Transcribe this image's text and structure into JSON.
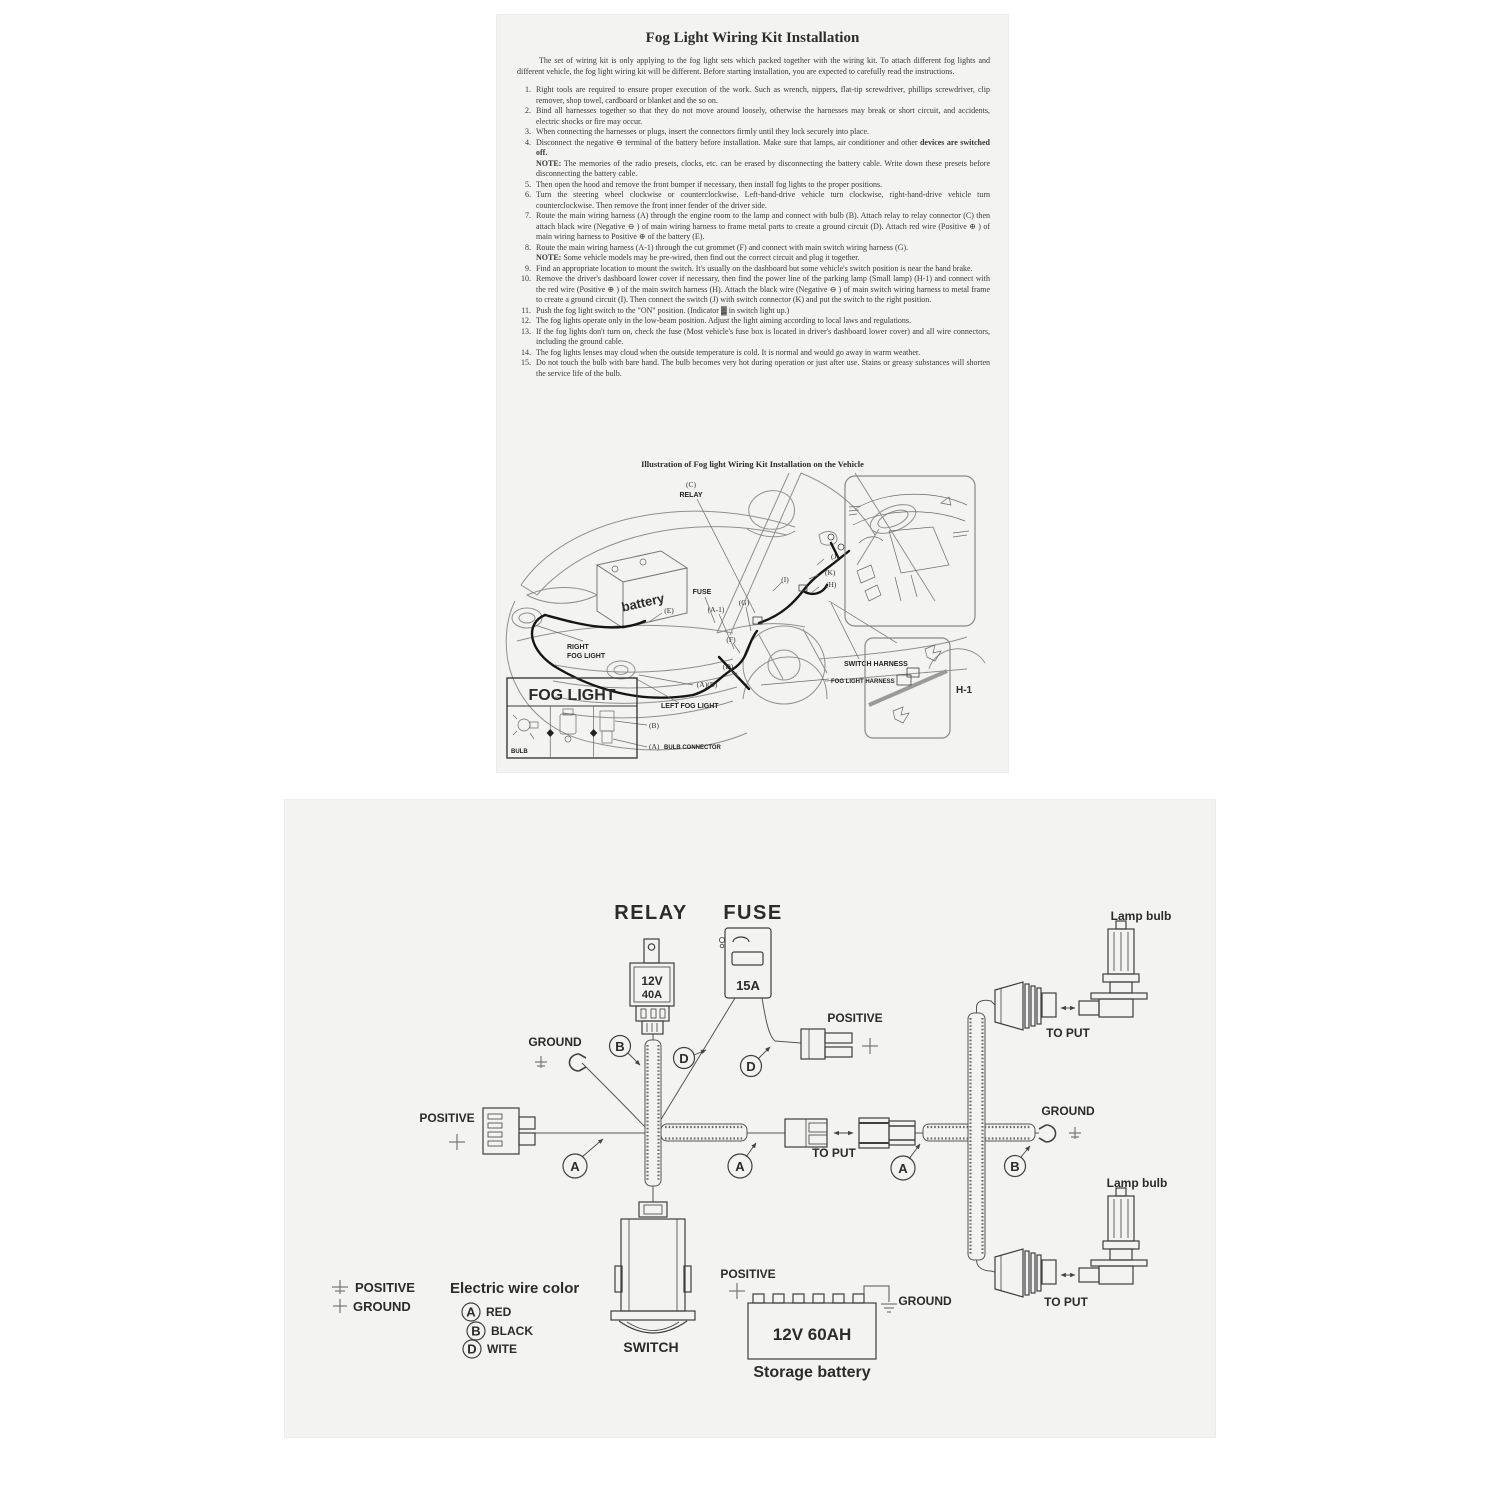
{
  "doc1": {
    "title": "Fog Light Wiring Kit Installation",
    "intro": "The set of wiring kit is only applying to the fog light sets which packed together with the wiring kit. To attach different fog lights and different vehicle, the fog light wiring kit will be different. Before starting installation, you are expected to carefully read the instructions.",
    "note_label": "NOTE:",
    "items": [
      {
        "num": "1.",
        "text": "Right tools are required to ensure proper execution of the work. Such as wrench, nippers, flat-tip screwdriver, phillips screwdriver, clip remover, shop towel, cardboard or blanket and the so on."
      },
      {
        "num": "2.",
        "text": "Bind all harnesses together so that they do not move around loosely, otherwise the harnesses may break or short circuit, and accidents, electric shocks or fire may occur."
      },
      {
        "num": "3.",
        "text": "When connecting the harnesses or plugs, insert the connectors firmly until they lock securely into place."
      },
      {
        "num": "4.",
        "text": "Disconnect the negative ⊖ terminal of the battery before installation. Make sure that lamps, air conditioner and other ",
        "bold": "devices are switched off.",
        "note": "The memories of the radio presets, clocks, etc. can be erased by disconnecting the battery cable. Write down these presets before disconnecting the battery cable."
      },
      {
        "num": "5.",
        "text": "Then open the hood and remove the front bumper if necessary, then install fog lights to the proper positions."
      },
      {
        "num": "6.",
        "text": "Turn the steering wheel clockwise or counterclockwise. Left-hand-drive vehicle turn clockwise, right-hand-drive vehicle turn counterclockwise. Then remove the front inner fender of the driver side."
      },
      {
        "num": "7.",
        "text": "Route the main wiring harness (A) through the engine room to the lamp and connect with bulb (B). Attach relay to relay connector (C) then attach black wire (Negative ⊖ ) of main wiring harness to frame metal parts to create a ground circuit (D). Attach red wire (Positive ⊕ ) of main wiring harness to Positive ⊕ of the battery (E)."
      },
      {
        "num": "8.",
        "text": "Route the main wiring harness (A-1) through the cut grommet (F) and connect with main switch wiring harness (G).",
        "note": "Some vehicle models may be pre-wired, then find out the correct circuit and plug it together."
      },
      {
        "num": "9.",
        "text": "Find an appropriate location to mount the switch. It's usually on the dashboard but some vehicle's switch position is near the hand brake."
      },
      {
        "num": "10.",
        "text": "Remove the driver's dashboard lower cover if necessary, then find the power line of the parking lamp (Small lamp) (H-1) and connect with the red wire (Positive ⊕ ) of the main switch harness (H). Attach the black wire (Negative ⊖ ) of main switch wiring harness to metal frame to create a ground circuit (I). Then connect the switch (J) with switch connector (K) and put the switch to the right position."
      },
      {
        "num": "11.",
        "text": "Push the fog light switch to the \"ON\" position. (Indicator ▓ in switch light up.)"
      },
      {
        "num": "12.",
        "text": "The fog lights operate only in the low-beam position. Adjust the light aiming according to local laws and regulations."
      },
      {
        "num": "13.",
        "text": "If the fog lights don't turn on, check the fuse (Most vehicle's fuse box is located in driver's dashboard lower cover) and all wire connectors, including the ground cable."
      },
      {
        "num": "14.",
        "text": "The fog lights lenses may cloud when the outside temperature is cold. It is normal and would go away in warm weather."
      },
      {
        "num": "15.",
        "text": "Do not touch the bulb with bare hand. The bulb becomes very hot during operation or just after use. Stains or greasy substances will shorten the service life of the bulb."
      }
    ],
    "illustration_caption": "Illustration of Fog light Wiring Kit Installation on the Vehicle",
    "labels": {
      "c": "(C)",
      "relay": "RELAY",
      "battery": "battery",
      "fuse": "FUSE",
      "e": "(E)",
      "a1": "(A-1)",
      "g": "(G)",
      "f": "(F)",
      "d": "(D)",
      "axb": "(A)(B)",
      "j": "(J)",
      "k": "(K)",
      "i": "(I)",
      "h": "(H)",
      "right1": "RIGHT",
      "right2": "FOG LIGHT",
      "switch_harness": "SWITCH HARNESS",
      "fog_harness": "FOG LIGHT HARNESS",
      "left_fog": "LEFT  FOG  LIGHT",
      "h1": "H-1",
      "fog_box_title": "FOG LIGHT",
      "bulb": "BULB",
      "b": "(B)",
      "a": "(A)",
      "bulb_conn": "BULB CONNECTOR"
    }
  },
  "doc2": {
    "relay": {
      "title": "RELAY",
      "line1": "12V",
      "line2": "40A"
    },
    "fuse": {
      "title": "FUSE",
      "amps": "15A"
    },
    "labels": {
      "ground_top": "GROUND",
      "positive_top": "POSITIVE",
      "positive_left": "POSITIVE",
      "to_put_mid": "TO PUT",
      "ground_right": "GROUND",
      "lamp_bulb_top": "Lamp bulb",
      "to_put_top": "TO PUT",
      "lamp_bulb_bottom": "Lamp bulb",
      "to_put_bottom": "TO PUT",
      "switch": "SWITCH",
      "positive_battery": "POSITIVE",
      "ground_battery": "GROUND"
    },
    "battery": {
      "rating": "12V  60AH",
      "caption": "Storage battery"
    },
    "legend": {
      "positive": "POSITIVE",
      "ground": "GROUND",
      "title": "Electric wire color",
      "entries": [
        {
          "code": "A",
          "name": "RED"
        },
        {
          "code": "B",
          "name": "BLACK"
        },
        {
          "code": "D",
          "name": "WITE"
        }
      ]
    },
    "tags": {
      "a": "A",
      "b": "B",
      "d": "D"
    }
  }
}
